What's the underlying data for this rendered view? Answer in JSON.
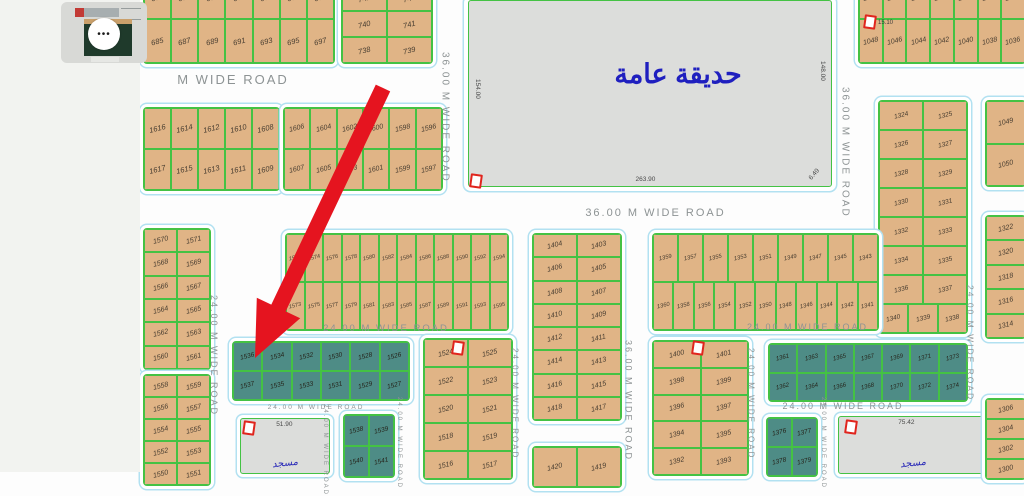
{
  "colors": {
    "parcel_fill": "#e0b486",
    "parcel_border": "#44c244",
    "highlight_fill": "#4e8c86",
    "road_outline": "#b2e1f1",
    "road_label": "#8d9394",
    "arrow": "#e5141f",
    "park_fill": "#dcdddb",
    "park_text": "#1f1fbf",
    "marker_red": "#e0251e"
  },
  "thumbnail": {
    "more_label": "•••"
  },
  "park": {
    "label": "حديقة عامة",
    "dim_left": "154.00",
    "dim_right": "148.00",
    "dim_bottom": "263.90",
    "dim_corner": "6.49"
  },
  "mosques": [
    {
      "label": "مسجد",
      "dim": "51.90"
    },
    {
      "label": "مسجد",
      "dim": "75.42"
    }
  ],
  "map": {
    "arrow_color": "#e5141f",
    "blocks": [
      {
        "id": "684-697",
        "x": 143,
        "y": -26,
        "w": 190,
        "h": 88,
        "fs": 7.5,
        "highlighted": false,
        "rows": [
          [
            "684",
            "686",
            "688",
            "690",
            "692",
            "694",
            "696"
          ],
          [
            "685",
            "687",
            "689",
            "691",
            "693",
            "695",
            "697"
          ]
        ]
      },
      {
        "id": "738-743",
        "x": 341,
        "y": -16,
        "w": 90,
        "h": 78,
        "fs": 7.5,
        "highlighted": false,
        "rows": [
          [
            "742",
            "743"
          ],
          [
            "740",
            "741"
          ],
          [
            "738",
            "739"
          ]
        ]
      },
      {
        "id": "1035-1048",
        "x": 858,
        "y": -26,
        "w": 166,
        "h": 88,
        "fs": 7,
        "highlighted": false,
        "rows": [
          [
            "1047",
            "1045",
            "1043",
            "1041",
            "1039",
            "1037",
            "1035"
          ],
          [
            "1048",
            "1046",
            "1044",
            "1042",
            "1040",
            "1038",
            "1036"
          ]
        ]
      },
      {
        "id": "1049-1050",
        "x": 985,
        "y": 100,
        "w": 39,
        "h": 85,
        "fs": 7,
        "highlighted": false,
        "rows": [
          [
            "1049"
          ],
          [
            "1050"
          ]
        ]
      },
      {
        "id": "1324-1340",
        "x": 878,
        "y": 100,
        "w": 88,
        "h": 232,
        "fs": 6.5,
        "highlighted": false,
        "rows": [
          [
            "1324",
            "1325"
          ],
          [
            "1326",
            "1327"
          ],
          [
            "1328",
            "1329"
          ],
          [
            "1330",
            "1331"
          ],
          [
            "1332",
            "1333"
          ],
          [
            "1334",
            "1335"
          ],
          [
            "1336",
            "1337"
          ],
          [
            "1340",
            "1339",
            "1338"
          ]
        ]
      },
      {
        "id": "1608-1617",
        "x": 143,
        "y": 107,
        "w": 135,
        "h": 82,
        "fs": 7.5,
        "highlighted": false,
        "rows": [
          [
            "1616",
            "1614",
            "1612",
            "1610",
            "1608"
          ],
          [
            "1617",
            "1615",
            "1613",
            "1611",
            "1609"
          ]
        ]
      },
      {
        "id": "1596-1607",
        "x": 283,
        "y": 107,
        "w": 158,
        "h": 82,
        "fs": 7,
        "highlighted": false,
        "rows": [
          [
            "1606",
            "1604",
            "1602",
            "1600",
            "1598",
            "1596"
          ],
          [
            "1607",
            "1605",
            "1603",
            "1601",
            "1599",
            "1597"
          ]
        ]
      },
      {
        "id": "1560-1571",
        "x": 143,
        "y": 228,
        "w": 66,
        "h": 140,
        "fs": 7,
        "highlighted": false,
        "rows": [
          [
            "1570",
            "1571"
          ],
          [
            "1568",
            "1569"
          ],
          [
            "1566",
            "1567"
          ],
          [
            "1564",
            "1565"
          ],
          [
            "1562",
            "1563"
          ],
          [
            "1560",
            "1561"
          ]
        ]
      },
      {
        "id": "1550-1559",
        "x": 143,
        "y": 374,
        "w": 66,
        "h": 110,
        "fs": 7,
        "highlighted": false,
        "rows": [
          [
            "1558",
            "1559"
          ],
          [
            "1556",
            "1557"
          ],
          [
            "1554",
            "1555"
          ],
          [
            "1552",
            "1553"
          ],
          [
            "1550",
            "1551"
          ]
        ]
      },
      {
        "id": "1572-1595",
        "x": 285,
        "y": 233,
        "w": 222,
        "h": 96,
        "fs": 5.5,
        "highlighted": false,
        "rows": [
          [
            "1572",
            "1574",
            "1576",
            "1578",
            "1580",
            "1582",
            "1584",
            "1586",
            "1588",
            "1590",
            "1592",
            "1594"
          ],
          [
            "1573",
            "1575",
            "1577",
            "1579",
            "1581",
            "1583",
            "1585",
            "1587",
            "1589",
            "1591",
            "1593",
            "1595"
          ]
        ]
      },
      {
        "id": "1403-1418",
        "x": 532,
        "y": 233,
        "w": 88,
        "h": 186,
        "fs": 7,
        "highlighted": false,
        "rows": [
          [
            "1404",
            "1403"
          ],
          [
            "1406",
            "1405"
          ],
          [
            "1408",
            "1407"
          ],
          [
            "1410",
            "1409"
          ],
          [
            "1412",
            "1411"
          ],
          [
            "1414",
            "1413"
          ],
          [
            "1416",
            "1415"
          ],
          [
            "1418",
            "1417"
          ]
        ]
      },
      {
        "id": "1419-1420",
        "x": 532,
        "y": 446,
        "w": 88,
        "h": 40,
        "fs": 7,
        "highlighted": false,
        "rows": [
          [
            "1420",
            "1419"
          ]
        ]
      },
      {
        "id": "1341-1360",
        "x": 652,
        "y": 233,
        "w": 225,
        "h": 96,
        "fs": 5.8,
        "highlighted": false,
        "rows": [
          [
            "1359",
            "1357",
            "1355",
            "1353",
            "1351",
            "1349",
            "1347",
            "1345",
            "1343"
          ],
          [
            "1360",
            "1358",
            "1356",
            "1354",
            "1352",
            "1350",
            "1348",
            "1346",
            "1344",
            "1342",
            "1341"
          ]
        ]
      },
      {
        "id": "1314-1322",
        "x": 985,
        "y": 215,
        "w": 39,
        "h": 122,
        "fs": 7,
        "highlighted": false,
        "rows": [
          [
            "1322"
          ],
          [
            "1320"
          ],
          [
            "1318"
          ],
          [
            "1316"
          ],
          [
            "1314"
          ]
        ]
      },
      {
        "id": "1300-1306",
        "x": 985,
        "y": 398,
        "w": 39,
        "h": 80,
        "fs": 7,
        "highlighted": false,
        "rows": [
          [
            "1306"
          ],
          [
            "1304"
          ],
          [
            "1302"
          ],
          [
            "1300"
          ]
        ]
      },
      {
        "id": "1526-1537",
        "x": 232,
        "y": 341,
        "w": 176,
        "h": 58,
        "fs": 6.5,
        "highlighted": true,
        "rows": [
          [
            "1536",
            "1534",
            "1532",
            "1530",
            "1528",
            "1526"
          ],
          [
            "1537",
            "1535",
            "1533",
            "1531",
            "1529",
            "1527"
          ]
        ]
      },
      {
        "id": "1516-1525",
        "x": 423,
        "y": 338,
        "w": 88,
        "h": 140,
        "fs": 7,
        "highlighted": false,
        "rows": [
          [
            "1524",
            "1525"
          ],
          [
            "1522",
            "1523"
          ],
          [
            "1520",
            "1521"
          ],
          [
            "1518",
            "1519"
          ],
          [
            "1516",
            "1517"
          ]
        ]
      },
      {
        "id": "1392-1401",
        "x": 652,
        "y": 340,
        "w": 95,
        "h": 134,
        "fs": 7,
        "highlighted": false,
        "rows": [
          [
            "1400",
            "1401"
          ],
          [
            "1398",
            "1399"
          ],
          [
            "1396",
            "1397"
          ],
          [
            "1394",
            "1395"
          ],
          [
            "1392",
            "1393"
          ]
        ]
      },
      {
        "id": "1361-1374",
        "x": 768,
        "y": 343,
        "w": 198,
        "h": 57,
        "fs": 6,
        "highlighted": true,
        "rows": [
          [
            "1361",
            "1363",
            "1365",
            "1367",
            "1369",
            "1371",
            "1373"
          ],
          [
            "1362",
            "1364",
            "1366",
            "1368",
            "1370",
            "1372",
            "1374"
          ]
        ]
      },
      {
        "id": "1538-1541",
        "x": 343,
        "y": 414,
        "w": 50,
        "h": 62,
        "fs": 6.5,
        "highlighted": true,
        "rows": [
          [
            "1538",
            "1539"
          ],
          [
            "1540",
            "1541"
          ]
        ]
      },
      {
        "id": "1376-1379",
        "x": 766,
        "y": 417,
        "w": 50,
        "h": 58,
        "fs": 6.5,
        "highlighted": true,
        "rows": [
          [
            "1376",
            "1377"
          ],
          [
            "1378",
            "1379"
          ]
        ]
      }
    ],
    "road_labels": [
      {
        "text": "M WIDE ROAD",
        "x": 148,
        "y": 70,
        "w": 170,
        "h": 18,
        "o": "h",
        "s": 13
      },
      {
        "text": "36.00 M WIDE ROAD",
        "x": 438,
        "y": 22,
        "w": 14,
        "h": 190,
        "o": "v",
        "s": 10
      },
      {
        "text": "36.00 M WIDE ROAD",
        "x": 578,
        "y": 205,
        "w": 155,
        "h": 16,
        "o": "h",
        "s": 11
      },
      {
        "text": "36.00 M WIDE ROAD",
        "x": 838,
        "y": 55,
        "w": 14,
        "h": 195,
        "o": "v",
        "s": 10
      },
      {
        "text": "24.00 M WIDE ROAD",
        "x": 207,
        "y": 238,
        "w": 14,
        "h": 235,
        "o": "v",
        "s": 9
      },
      {
        "text": "24.00 M WIDE ROAD",
        "x": 316,
        "y": 322,
        "w": 140,
        "h": 12,
        "o": "h",
        "s": 9.5
      },
      {
        "text": "24.00 M WIDE ROAD",
        "x": 750,
        "y": 321,
        "w": 115,
        "h": 11,
        "o": "h",
        "s": 9
      },
      {
        "text": "24.00 M WIDE ROAD",
        "x": 964,
        "y": 218,
        "w": 13,
        "h": 250,
        "o": "v",
        "s": 8.5
      },
      {
        "text": "24.00 M WIDE ROAD",
        "x": 278,
        "y": 403,
        "w": 76,
        "h": 9,
        "o": "h",
        "s": 6.5
      },
      {
        "text": "24.00 M WIDE ROAD",
        "x": 320,
        "y": 428,
        "w": 10,
        "h": 44,
        "o": "v",
        "s": 6
      },
      {
        "text": "24.00 M WIDE ROAD",
        "x": 394,
        "y": 413,
        "w": 10,
        "h": 59,
        "o": "v",
        "s": 6
      },
      {
        "text": "24.00 M WIDE ROAD",
        "x": 509,
        "y": 336,
        "w": 12,
        "h": 136,
        "o": "v",
        "s": 8
      },
      {
        "text": "36.00 M WIDE ROAD",
        "x": 622,
        "y": 330,
        "w": 13,
        "h": 142,
        "o": "v",
        "s": 9
      },
      {
        "text": "24.00 M WIDE ROAD",
        "x": 745,
        "y": 336,
        "w": 12,
        "h": 136,
        "o": "v",
        "s": 8
      },
      {
        "text": "24.00 M WIDE ROAD",
        "x": 783,
        "y": 400,
        "w": 120,
        "h": 11,
        "o": "h",
        "s": 9
      },
      {
        "text": "24.00 M WIDE ROAD",
        "x": 818,
        "y": 413,
        "w": 10,
        "h": 59,
        "o": "v",
        "s": 6
      }
    ],
    "markers": [
      {
        "x": 470,
        "y": 174,
        "label": ""
      },
      {
        "x": 864,
        "y": 15,
        "label": "15.10"
      },
      {
        "x": 452,
        "y": 341,
        "label": ""
      },
      {
        "x": 692,
        "y": 341,
        "label": ""
      },
      {
        "x": 243,
        "y": 421,
        "label": ""
      },
      {
        "x": 845,
        "y": 420,
        "label": ""
      }
    ]
  }
}
